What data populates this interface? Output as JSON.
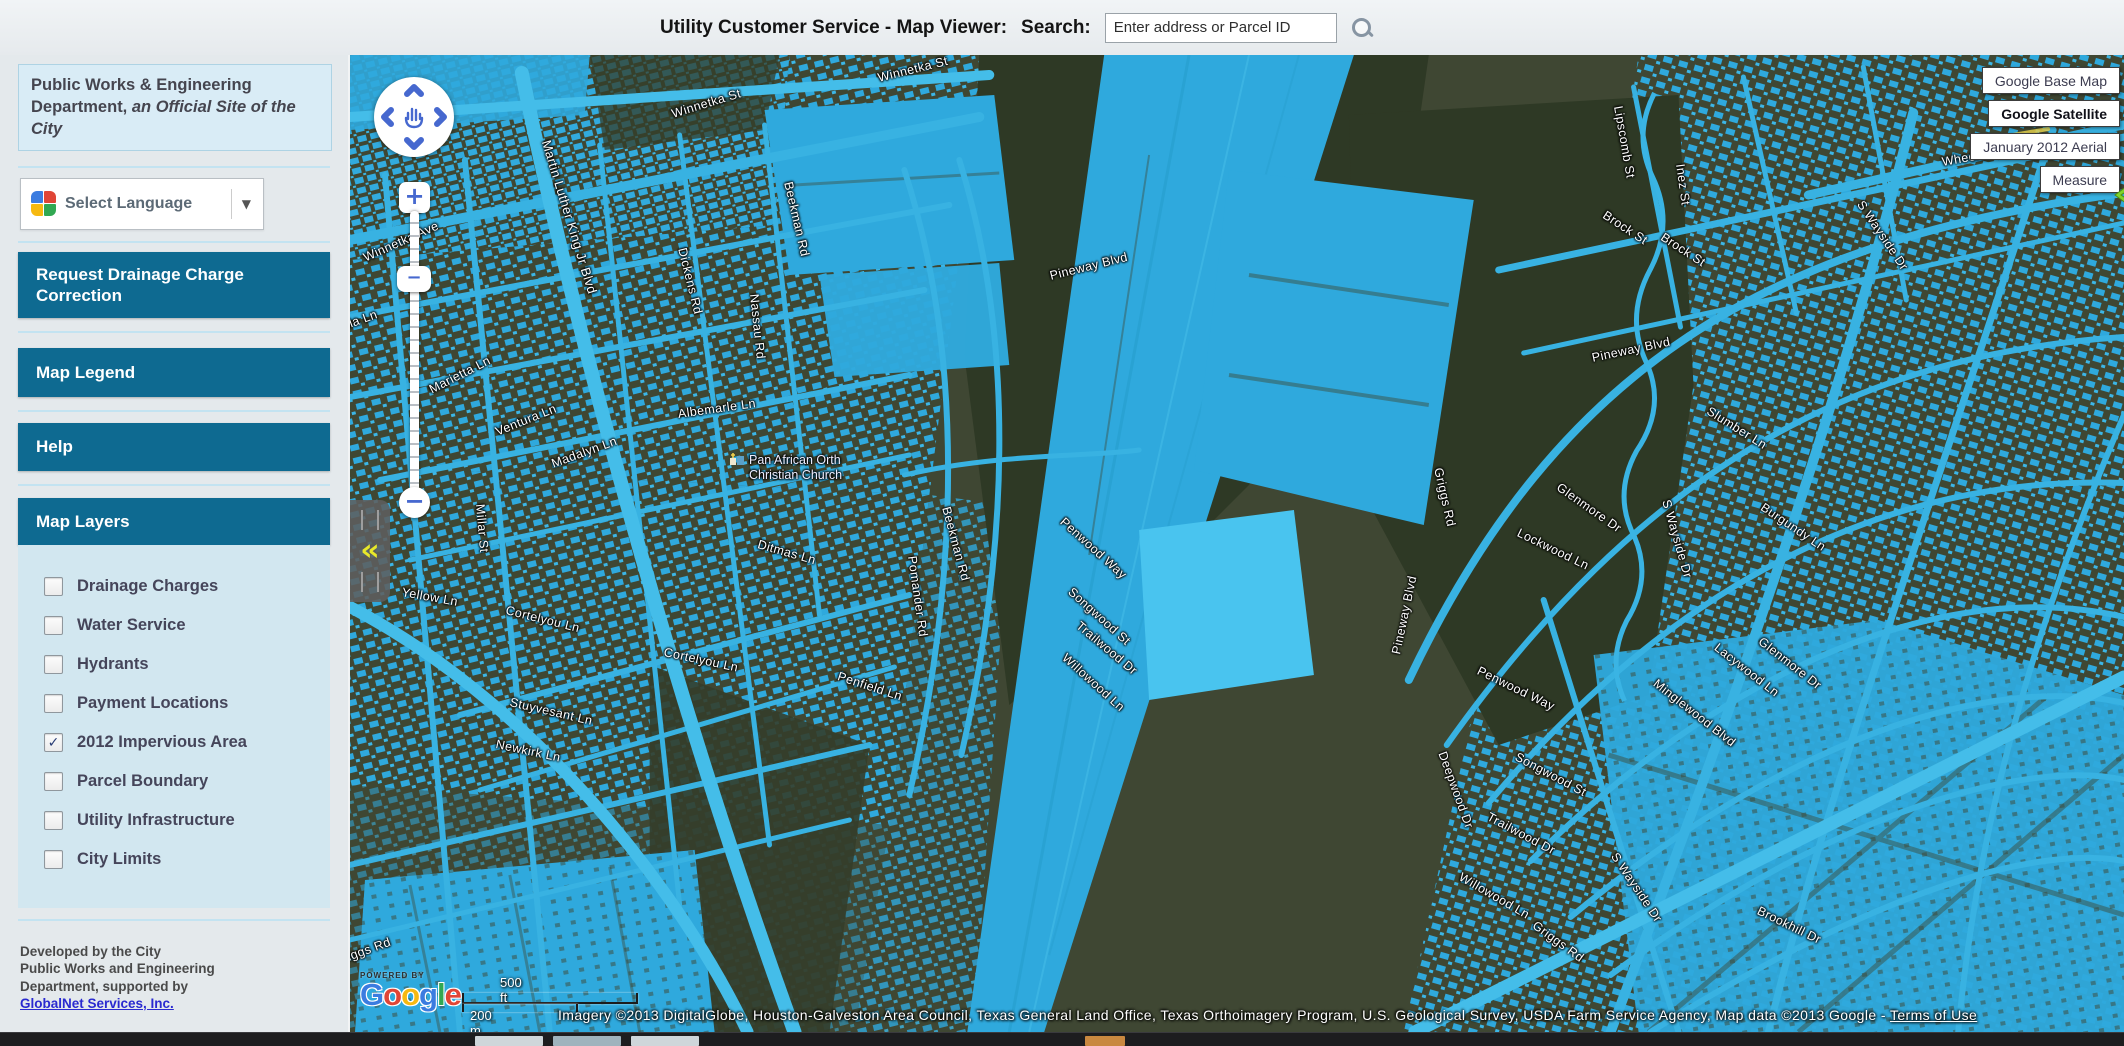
{
  "header": {
    "title": "Utility Customer Service - Map Viewer:",
    "search_label": "Search:",
    "search_placeholder": "Enter address or Parcel ID",
    "search_icon": "magnifier"
  },
  "sidebar": {
    "info_box": {
      "line1": "Public Works & Engineering Department, ",
      "line2_italic": "an Official Site of the City"
    },
    "language": {
      "label": "Select Language",
      "icon": "google-translate",
      "dropdown_glyph": "▼"
    },
    "buttons": [
      {
        "label": "Request Drainage Charge Correction"
      },
      {
        "label": "Map Legend"
      },
      {
        "label": "Help"
      }
    ],
    "map_layers": {
      "title": "Map Layers",
      "layers": [
        {
          "label": "Drainage Charges",
          "checked": false
        },
        {
          "label": "Water Service",
          "checked": false
        },
        {
          "label": "Hydrants",
          "checked": false
        },
        {
          "label": "Payment Locations",
          "checked": false
        },
        {
          "label": "2012 Impervious Area",
          "checked": true
        },
        {
          "label": "Parcel Boundary",
          "checked": false
        },
        {
          "label": "Utility Infrastructure",
          "checked": false
        },
        {
          "label": "City Limits",
          "checked": false
        }
      ],
      "check_glyph": "✓"
    },
    "footer": {
      "lines": [
        "Developed by the City",
        "Public Works and Engineering",
        "Department, supported by"
      ],
      "link": "GlobalNet Services, Inc."
    }
  },
  "map": {
    "type_buttons": [
      {
        "label": "Google Base Map",
        "active": false
      },
      {
        "label": "Google Satellite",
        "active": true
      },
      {
        "label": "January 2012 Aerial",
        "active": false
      },
      {
        "label": "Measure",
        "active": false
      }
    ],
    "controls": {
      "zoom_in": "+",
      "zoom_out": "−",
      "handle_glyph": "−",
      "collapse_glyph": "«"
    },
    "scale": {
      "ft": "500 ft",
      "m": "200 m"
    },
    "logo": {
      "powered_by": "POWERED BY",
      "letters": [
        [
          "G",
          "#3b7ce0"
        ],
        [
          "o",
          "#e04536"
        ],
        [
          "o",
          "#f6b911"
        ],
        [
          "g",
          "#3b7ce0"
        ],
        [
          "l",
          "#31a852"
        ],
        [
          "e",
          "#e04536"
        ]
      ]
    },
    "attribution": {
      "text": "Imagery ©2013 DigitalGlobe, Houston-Galveston Area Council, Texas General Land Office, Texas Orthoimagery Program, U.S. Geological Survey, USDA Farm Service Agency, Map data ©2013 Google - ",
      "link": "Terms of Use"
    },
    "poi": {
      "line1": "Pan African Orth",
      "line2": "Christian Church",
      "x": 380,
      "y": 398
    },
    "street_labels": [
      {
        "t": "Winnetka St",
        "x": 322,
        "y": 52,
        "r": -17
      },
      {
        "t": "Winnetka St",
        "x": 528,
        "y": 16,
        "r": -14
      },
      {
        "t": "Wheeler St",
        "x": 1592,
        "y": 100,
        "r": -10
      },
      {
        "t": "Winnetka Ave",
        "x": 14,
        "y": 196,
        "r": -24
      },
      {
        "t": "Martin Luther King Jr Blvd",
        "x": 196,
        "y": 78,
        "r": 73,
        "s": 13
      },
      {
        "t": "Mervilla Ln",
        "x": -34,
        "y": 274,
        "r": -20
      },
      {
        "t": "Marietta Ln",
        "x": 80,
        "y": 328,
        "r": -27
      },
      {
        "t": "Ventura Ln",
        "x": 146,
        "y": 370,
        "r": -22
      },
      {
        "t": "Madalyn Ln",
        "x": 202,
        "y": 402,
        "r": -20
      },
      {
        "t": "Albemarle Ln",
        "x": 328,
        "y": 352,
        "r": -8
      },
      {
        "t": "Dickens Rd",
        "x": 332,
        "y": 186,
        "r": 76
      },
      {
        "t": "Nassau Rd",
        "x": 404,
        "y": 232,
        "r": 84
      },
      {
        "t": "Beekman Rd",
        "x": 438,
        "y": 120,
        "r": 77
      },
      {
        "t": "Beekman Rd",
        "x": 596,
        "y": 445,
        "r": 75
      },
      {
        "t": "Ditmas Ln",
        "x": 408,
        "y": 482,
        "r": 16
      },
      {
        "t": "Pomander Rd",
        "x": 562,
        "y": 494,
        "r": 82
      },
      {
        "t": "Penfield Ln",
        "x": 488,
        "y": 614,
        "r": 18
      },
      {
        "t": "Cortelyou Ln",
        "x": 156,
        "y": 548,
        "r": 14
      },
      {
        "t": "Cortelyou Ln",
        "x": 314,
        "y": 590,
        "r": 12
      },
      {
        "t": "Stuyvesant Ln",
        "x": 160,
        "y": 640,
        "r": 13
      },
      {
        "t": "Newkirk Ln",
        "x": 146,
        "y": 682,
        "r": 12
      },
      {
        "t": "Millar St",
        "x": 130,
        "y": 442,
        "r": 85
      },
      {
        "t": "Yellow Ln",
        "x": 52,
        "y": 530,
        "r": 10
      },
      {
        "t": "Griggs Rd",
        "x": -16,
        "y": 900,
        "r": -20
      },
      {
        "t": "Griggs Rd",
        "x": 1184,
        "y": 862,
        "r": 36
      },
      {
        "t": "Griggs Rd",
        "x": 1088,
        "y": 406,
        "r": 77
      },
      {
        "t": "Pineway Blvd",
        "x": 700,
        "y": 214,
        "r": -14
      },
      {
        "t": "Pineway Blvd",
        "x": 1242,
        "y": 296,
        "r": -12
      },
      {
        "t": "Pineway Blvd",
        "x": 1046,
        "y": 592,
        "r": -78
      },
      {
        "t": "Slumber Ln",
        "x": 1358,
        "y": 348,
        "r": 32
      },
      {
        "t": "Glenmore Dr",
        "x": 1208,
        "y": 424,
        "r": 35
      },
      {
        "t": "Glenmore Dr",
        "x": 1410,
        "y": 578,
        "r": 38
      },
      {
        "t": "Burgundy Ln",
        "x": 1412,
        "y": 444,
        "r": 34
      },
      {
        "t": "S Wayside Dr",
        "x": 1316,
        "y": 438,
        "r": 74
      },
      {
        "t": "S Wayside Dr",
        "x": 1264,
        "y": 792,
        "r": 56
      },
      {
        "t": "S Wayside Dr",
        "x": 1510,
        "y": 140,
        "r": 56
      },
      {
        "t": "Lockwood Ln",
        "x": 1168,
        "y": 470,
        "r": 26
      },
      {
        "t": "Penwood Way",
        "x": 1128,
        "y": 608,
        "r": 26
      },
      {
        "t": "Songwood St",
        "x": 1166,
        "y": 694,
        "r": 28
      },
      {
        "t": "Trailwood Dr",
        "x": 1138,
        "y": 754,
        "r": 28
      },
      {
        "t": "Willowood Ln",
        "x": 1110,
        "y": 814,
        "r": 30
      },
      {
        "t": "Deepwood Dr",
        "x": 1092,
        "y": 690,
        "r": 70
      },
      {
        "t": "Minglewood Blvd",
        "x": 1305,
        "y": 620,
        "r": 38
      },
      {
        "t": "Lacywood Ln",
        "x": 1366,
        "y": 584,
        "r": 38
      },
      {
        "t": "Brookhill Dr",
        "x": 1408,
        "y": 848,
        "r": 26
      },
      {
        "t": "Brock St",
        "x": 1254,
        "y": 152,
        "r": 33
      },
      {
        "t": "Brock St",
        "x": 1312,
        "y": 174,
        "r": 33
      },
      {
        "t": "Lipscomb St",
        "x": 1268,
        "y": 44,
        "r": 80
      },
      {
        "t": "Inez St",
        "x": 1330,
        "y": 102,
        "r": 82
      },
      {
        "t": "Penwood Way",
        "x": 712,
        "y": 458,
        "r": 42
      },
      {
        "t": "Songwood St",
        "x": 720,
        "y": 528,
        "r": 42
      },
      {
        "t": "Trailwood Dr",
        "x": 728,
        "y": 562,
        "r": 40
      },
      {
        "t": "Willowood Ln",
        "x": 714,
        "y": 594,
        "r": 42
      }
    ]
  },
  "colors": {
    "impervious_overlay": "#2fa9dd",
    "sidebar_button": "#0e6a91",
    "layers_panel": "#d2e7f0",
    "map_base": "#3f4733",
    "forest": "#2e3925",
    "control_blue": "#4668cf",
    "collapse_yellow": "#e8e82a",
    "green_arrow": "#7fd42c"
  }
}
